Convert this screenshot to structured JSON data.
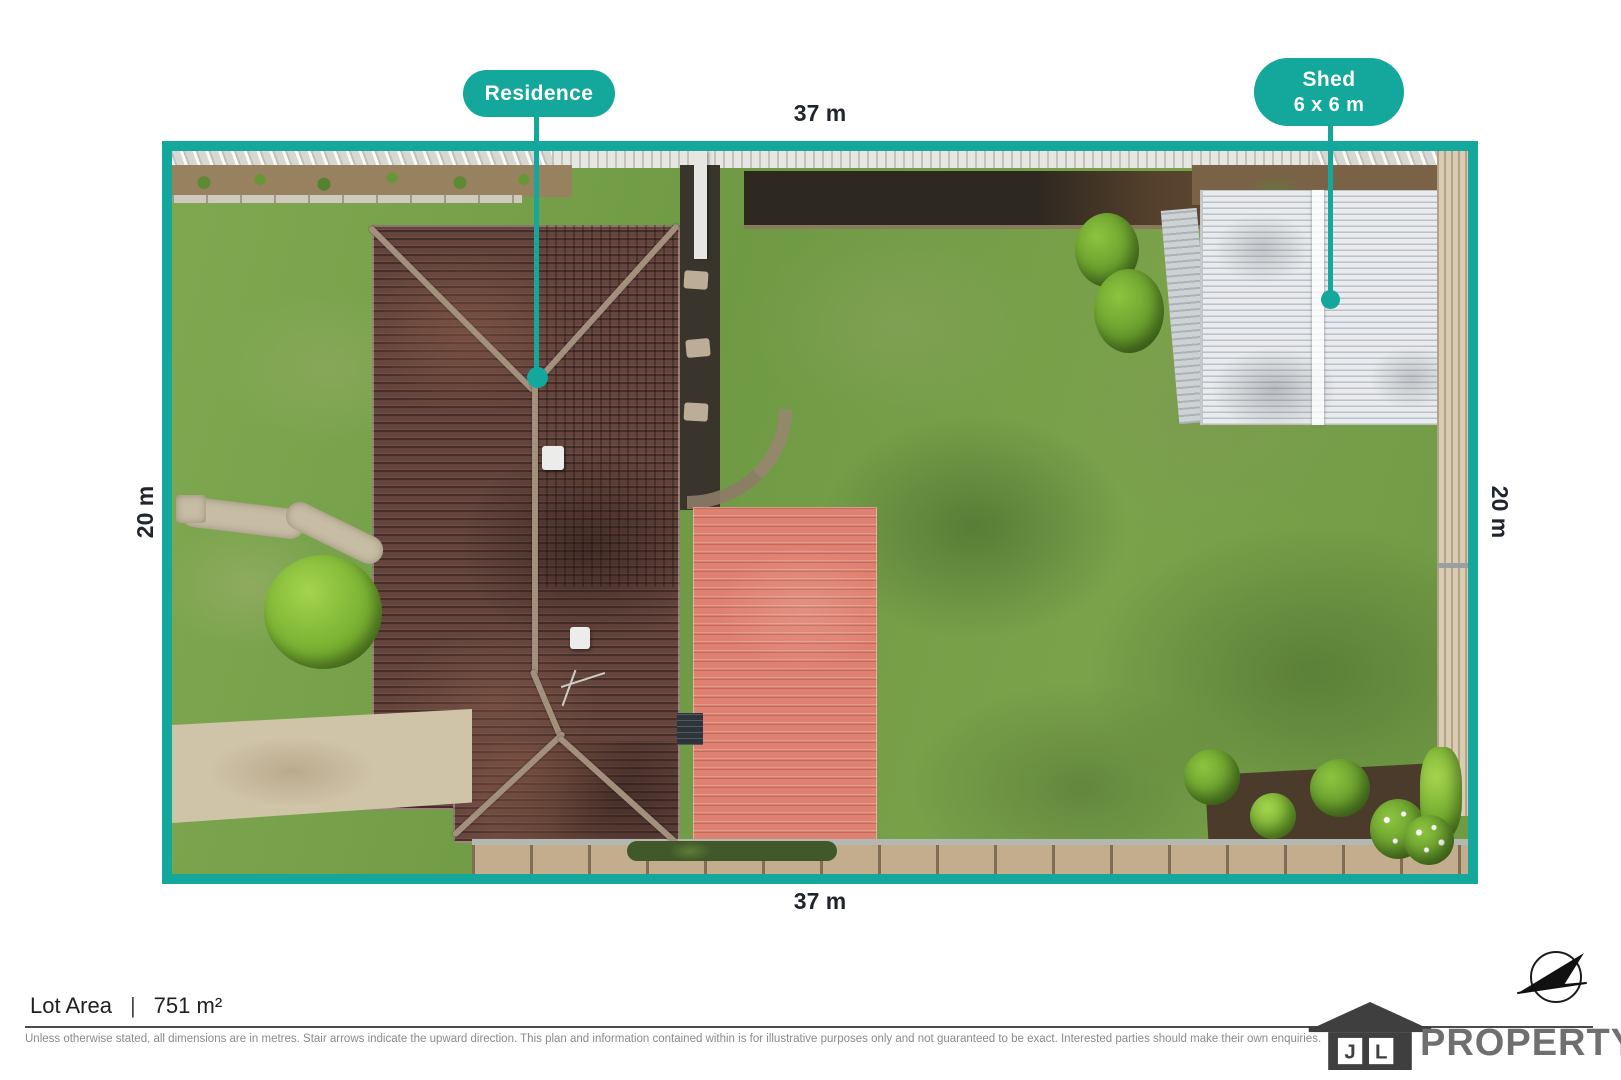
{
  "plan": {
    "callouts": [
      {
        "id": "residence",
        "label": "Residence"
      },
      {
        "id": "shed",
        "label": "Shed",
        "sublabel": "6 x 6 m"
      }
    ],
    "dimensions": {
      "top": "37 m",
      "bottom": "37 m",
      "left": "20 m",
      "right": "20 m"
    }
  },
  "footer": {
    "lot_area_label": "Lot Area",
    "separator": "|",
    "lot_area_value": "751 m²",
    "disclaimer": "Unless otherwise stated, all dimensions are in metres. Stair arrows indicate the upward direction. This plan and information contained within is for illustrative purposes only and not guaranteed to be exact. Interested parties should make their own enquiries."
  },
  "brand": {
    "initial_1": "J",
    "initial_2": "L",
    "name": "PROPERTY"
  },
  "colors": {
    "accent_teal": "#14A79B",
    "text_dark": "#21252C",
    "disclaimer_gray": "#8A8A8A",
    "logo_dark": "#3F3F3F",
    "logo_gray": "#6F6F6F",
    "roof_brown": "#64443C",
    "roof_salmon": "#DF8170",
    "shed_white": "#E9EBEE",
    "grass_green": "#6F9A44"
  }
}
